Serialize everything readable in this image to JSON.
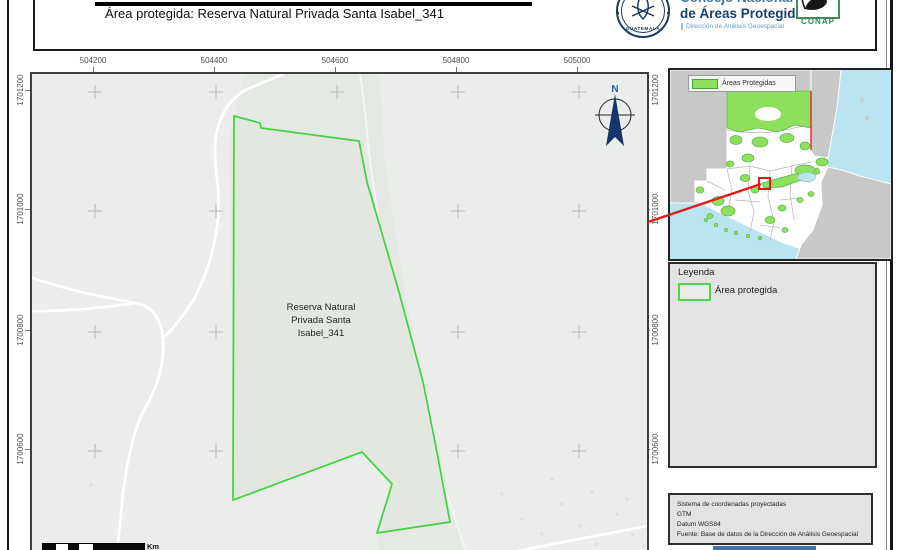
{
  "header": {
    "title": "Área protegida: Reserva Natural Privada Santa Isabel_341",
    "org_line1": "Consejo Nacional",
    "org_line2": "de Áreas Protegidas",
    "org_subtitle": "Dirección de Análisis Geoespacial",
    "seal_text": "GUATEMALA",
    "conap_text": "CONAP"
  },
  "map": {
    "x_ticks": [
      "504200",
      "504400",
      "504600",
      "504800",
      "505000"
    ],
    "y_ticks": [
      "1701200",
      "1701000",
      "1700800",
      "1700600"
    ],
    "area_label_lines": [
      "Reserva Natural",
      "Privada Santa",
      "Isabel_341"
    ],
    "north_label": "N"
  },
  "overview": {
    "legend_label": "Áreas Protegidas"
  },
  "legend": {
    "title": "Leyenda",
    "item": "Área protegida"
  },
  "scalebar": {
    "unit": "Km"
  },
  "info": {
    "lines": [
      "Sistema de coordenadas proyectadas",
      "GTM",
      "Datum WGS84",
      "Fuente: Base de datos de la Dirección de Análisis Geoespacial"
    ]
  },
  "colors": {
    "protected_area_stroke": "#3fd43f",
    "protected_area_fill": "#e2e8e0",
    "overview_protected": "#8fdf5f",
    "water": "#b9e4f0",
    "neighbor_land": "#c8c8c8",
    "marker_red": "#e31a1a",
    "north_navy": "#14356e",
    "conap_green": "#2e8b57"
  }
}
